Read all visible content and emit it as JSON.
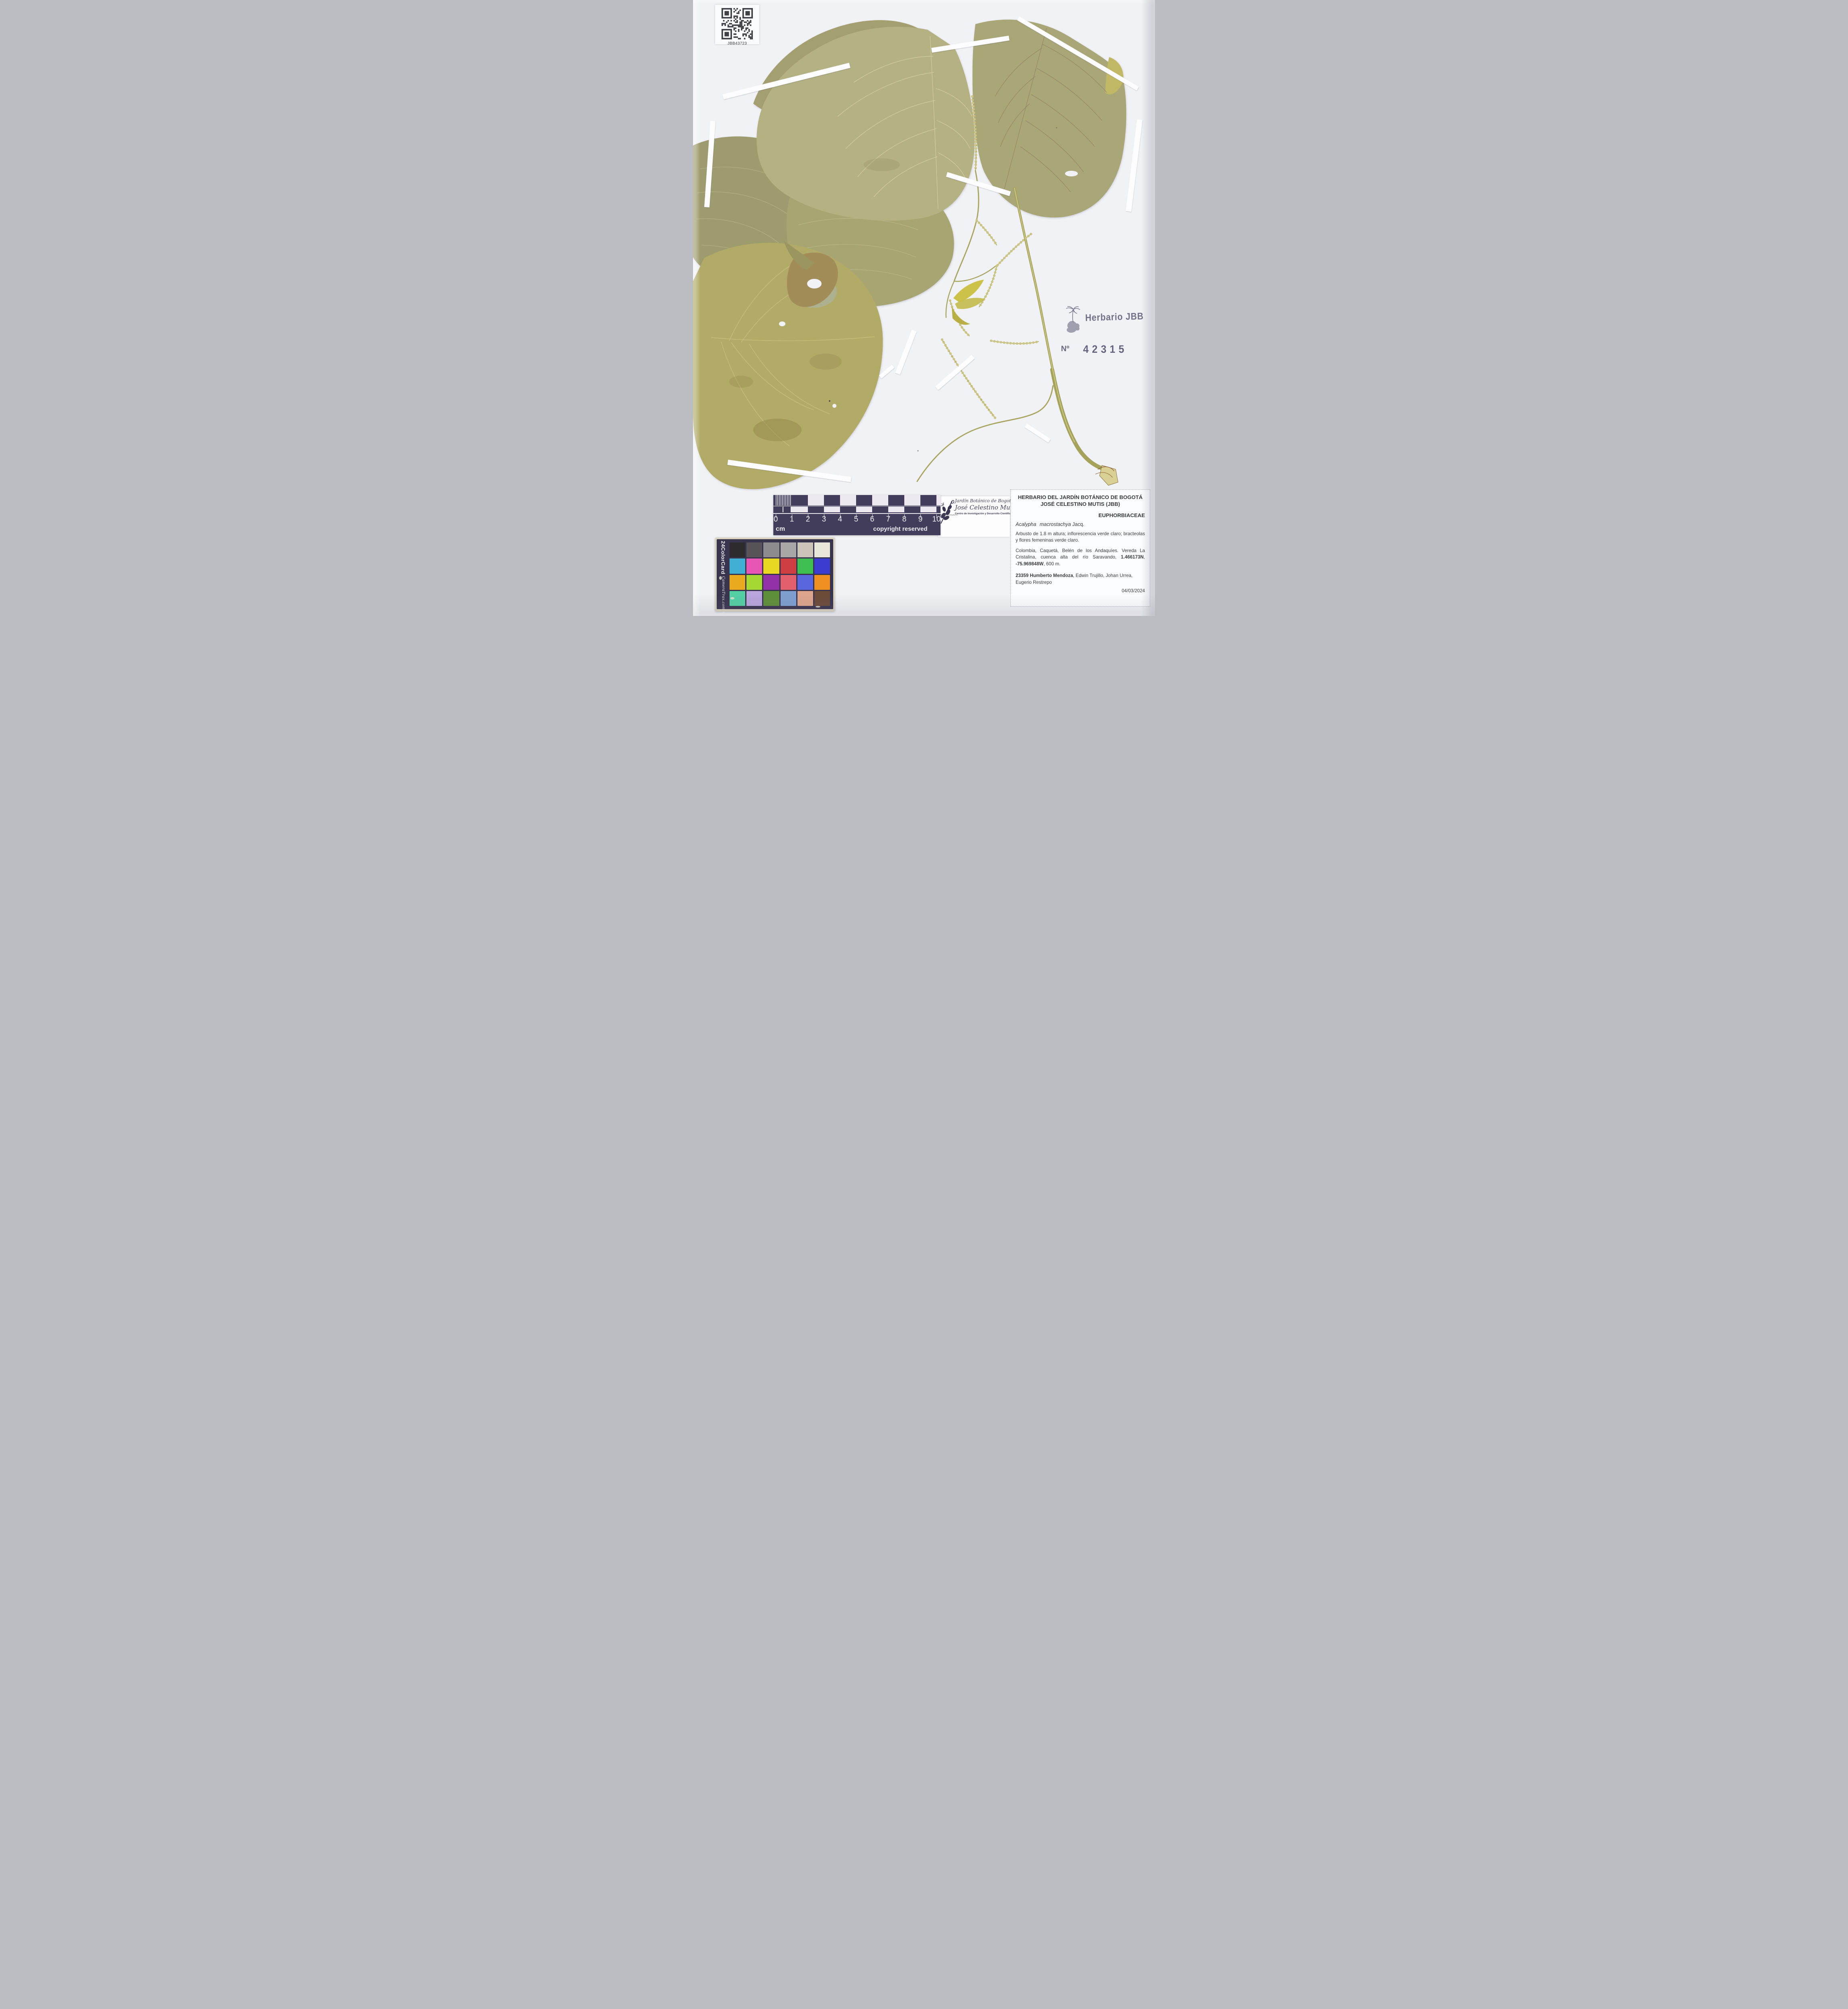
{
  "qr_label": {
    "code": "JBB43723"
  },
  "stamp": {
    "text": "Herbario JBB",
    "number_label": "Nº",
    "number": "42315",
    "ink_color": "#514f6b"
  },
  "ruler": {
    "ticks": [
      "0",
      "1",
      "2",
      "3",
      "4",
      "5",
      "6",
      "7",
      "8",
      "9",
      "10"
    ],
    "unit": "cm",
    "copyright": "copyright reserved"
  },
  "logo_card": {
    "line1": "Jardín Botánico de Bogotá",
    "line2": "José Celestino Mutis",
    "line3": "Centro de Investigación y Desarrollo Científico",
    "illustration_caption": "Mutisia clematis L."
  },
  "label": {
    "header_line1": "HERBARIO DEL JARDÍN BOTÁNICO DE BOGOTÁ",
    "header_line2": "JOSÉ CELESTINO MUTIS (JBB)",
    "family": "EUPHORBIACEAE",
    "species": "Acalypha macrostachya",
    "author": " Jacq.",
    "description": "Arbusto de 1.8 m altura; inflorescencia verde claro; bracteolas y flores femeninas verde claro.",
    "locality_part1": "Colombia, Caquetá, Belén de los Andaquíes. Vereda La Cristalina, cuenca alta del río Saravando, ",
    "coord_lat": "1.466173N",
    "locality_sep": ", ",
    "coord_lon": "-75.969848W",
    "locality_part2": ", 600 m.",
    "collectors_bold": "23359 Humberto Mendoza",
    "collectors_rest": ", Edwin Trujillo, Johan Urrea, Eugerio Restrepo",
    "date": "04/03/2024"
  },
  "color_card": {
    "side_title": "24ColorCard",
    "side_brand": "CameraTrax.com",
    "side_tm": "TM",
    "rows": [
      [
        "#2e2b2e",
        "#595459",
        "#8f8c90",
        "#aaa6a6",
        "#cbc4b8",
        "#e9e6da"
      ],
      [
        "#3fb0d4",
        "#e857b4",
        "#ead71f",
        "#cf3f41",
        "#3fbf52",
        "#3a3ed0"
      ],
      [
        "#eaaa1f",
        "#a5d832",
        "#9232a8",
        "#e2606e",
        "#5a66dd",
        "#ef8f1f"
      ],
      [
        "#54cfa4",
        "#b9a4dc",
        "#5d8f3a",
        "#7e9ecf",
        "#dda58c",
        "#6b4a38"
      ]
    ]
  }
}
